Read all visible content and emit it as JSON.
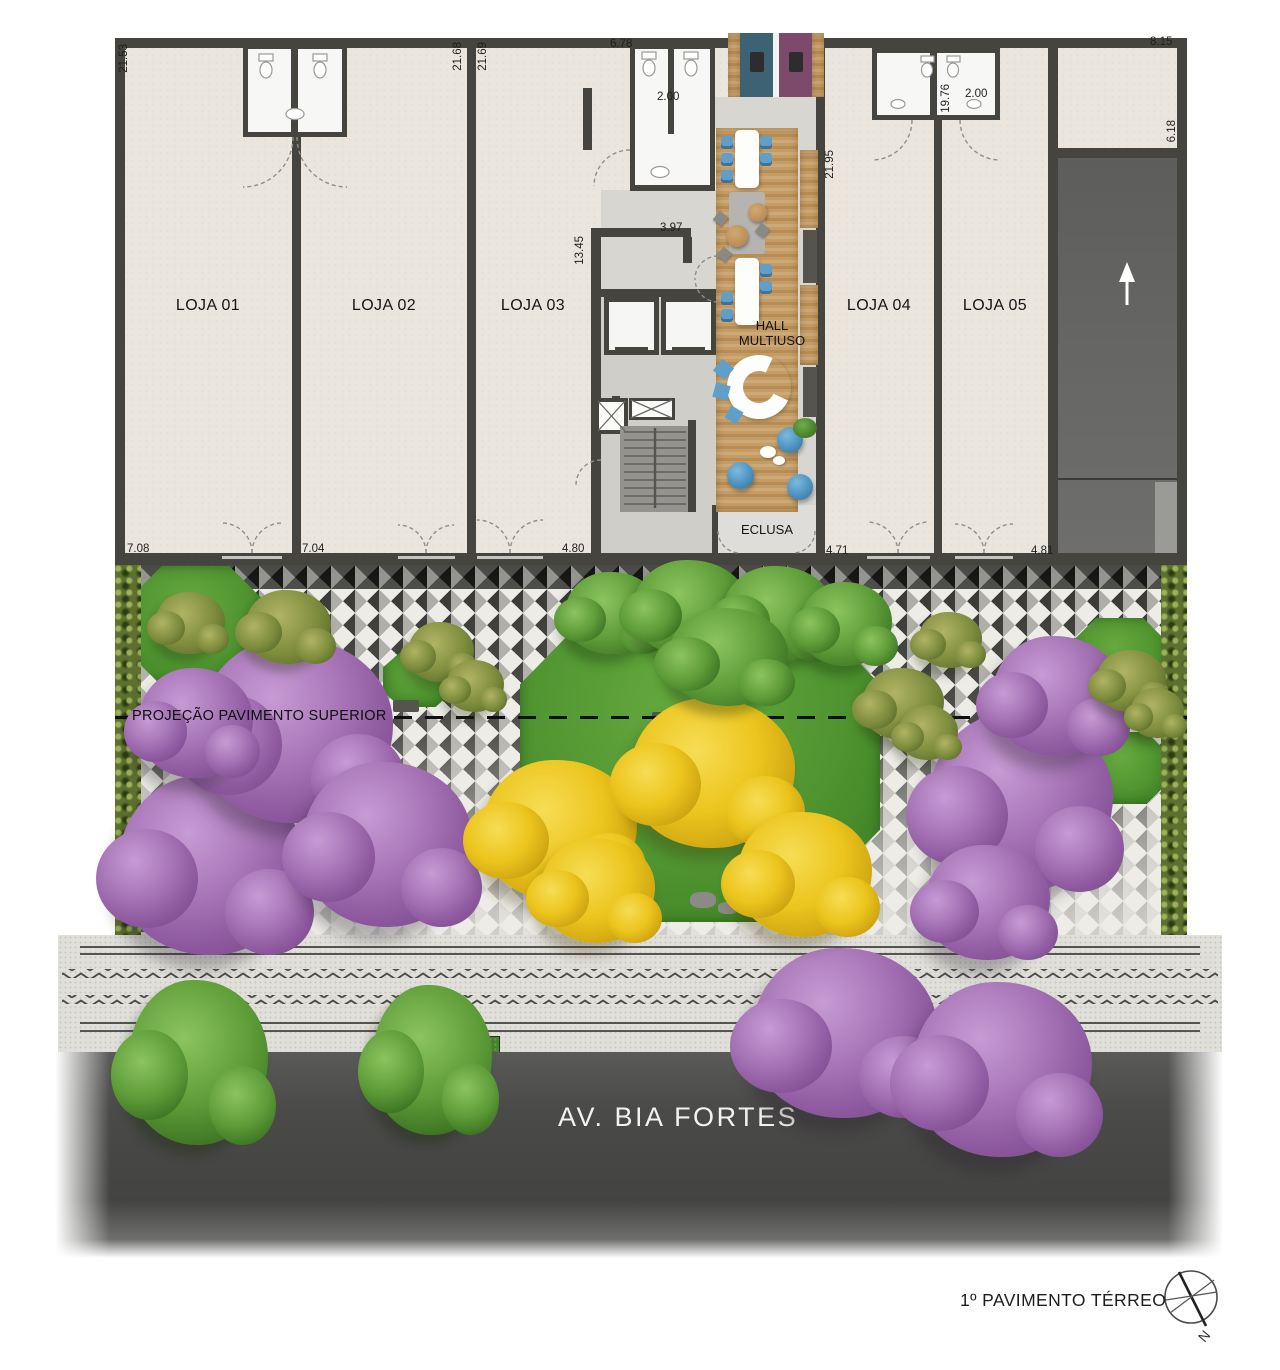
{
  "title": "1º PAVIMENTO TÉRREO",
  "compass": {
    "north": "N"
  },
  "street": {
    "name": "AV. BIA FORTES"
  },
  "plaza": {
    "projection_label": "PROJEÇÃO PAVIMENTO SUPERIOR"
  },
  "rooms": {
    "loja01": "LOJA 01",
    "loja02": "LOJA 02",
    "loja03": "LOJA 03",
    "loja04": "LOJA 04",
    "loja05": "LOJA 05",
    "hall_line1": "HALL",
    "hall_line2": "MULTIUSO",
    "eclusa": "ECLUSA"
  },
  "dimensions": {
    "left_height": "21.53",
    "wall_l2_l3_left": "21.68",
    "wall_l2_l3_right": "21.69",
    "top_mid_width": "6.78",
    "wc_mid_width": "2.00",
    "top_right_width": "8.15",
    "right_upper_height": "6.18",
    "hall_right_height": "21.95",
    "wall_l4_height": "19.76",
    "wc_right_width": "2.00",
    "core_height": "13.45",
    "core_width": "3.97",
    "front_loja01": "7.08",
    "front_loja02": "7.04",
    "front_loja03": "4.80",
    "front_loja04": "4.71",
    "front_loja05": "4.81"
  },
  "colors": {
    "wall": "#45443f",
    "floor": "#eae6dd",
    "corefloor": "#d7d6d1",
    "wood": "#c59c64",
    "teal": "#3c6273",
    "purple": "#7d4a6c",
    "chair": "#5f9fca",
    "grass": "#4f9430",
    "yellow": "#ecc51d",
    "treepurple": "#a273b1",
    "hedge": "#5d7030",
    "road": "#4a4a48",
    "paving": "#2c2c2a",
    "pavingbg": "#edece7"
  }
}
